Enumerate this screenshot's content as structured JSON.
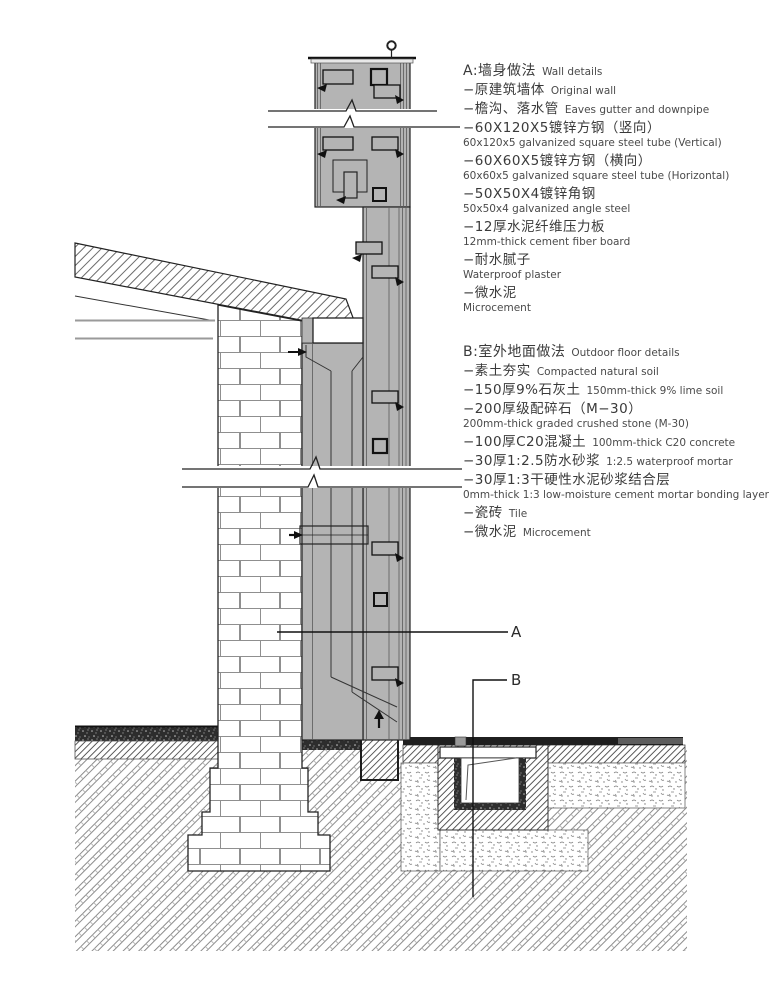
{
  "drawing": {
    "section_marker_a": "A",
    "section_marker_b": "B"
  },
  "colors": {
    "wall_fill": "#b4b4b4",
    "outline": "#1a1a1a",
    "text": "#3a3a3a",
    "tile_band": "#1f1f1f"
  },
  "annotations": {
    "block_a": {
      "heading_zh": "A:墙身做法",
      "heading_en": "Wall details",
      "items": [
        {
          "zh": "−原建筑墙体",
          "en": "Original wall",
          "inline": true
        },
        {
          "zh": "−檐沟、落水管",
          "en": "Eaves gutter and downpipe",
          "inline": true
        },
        {
          "zh": "−60X120X5镀锌方钢（竖向）",
          "en": "60x120x5 galvanized square steel tube (Vertical)",
          "inline": false
        },
        {
          "zh": "−60X60X5镀锌方钢（横向）",
          "en": "60x60x5 galvanized square steel tube (Horizontal)",
          "inline": false
        },
        {
          "zh": "−50X50X4镀锌角钢",
          "en": "50x50x4 galvanized angle steel",
          "inline": false
        },
        {
          "zh": "−12厚水泥纤维压力板",
          "en": "12mm-thick cement fiber board",
          "inline": false
        },
        {
          "zh": "−耐水腻子",
          "en": "Waterproof plaster",
          "inline": false
        },
        {
          "zh": "−微水泥",
          "en": "Microcement",
          "inline": false
        }
      ]
    },
    "block_b": {
      "heading_zh": "B:室外地面做法",
      "heading_en": "Outdoor floor details",
      "items": [
        {
          "zh": "−素土夯实",
          "en": "Compacted natural soil",
          "inline": true
        },
        {
          "zh": "−150厚9%石灰土",
          "en": "150mm-thick 9% lime soil",
          "inline": true
        },
        {
          "zh": "−200厚级配碎石（M−30）",
          "en": "200mm-thick graded crushed stone (M-30)",
          "inline": false
        },
        {
          "zh": "−100厚C20混凝土",
          "en": "100mm-thick C20 concrete",
          "inline": true
        },
        {
          "zh": "−30厚1:2.5防水砂浆",
          "en": "1:2.5 waterproof mortar",
          "inline": true
        },
        {
          "zh": "−30厚1:3干硬性水泥砂浆结合层",
          "en": "0mm-thick 1:3 low-moisture cement mortar bonding layer",
          "inline": false
        },
        {
          "zh": "−瓷砖",
          "en": "Tile",
          "inline": true
        },
        {
          "zh": "−微水泥",
          "en": "Microcement",
          "inline": true
        }
      ]
    }
  }
}
